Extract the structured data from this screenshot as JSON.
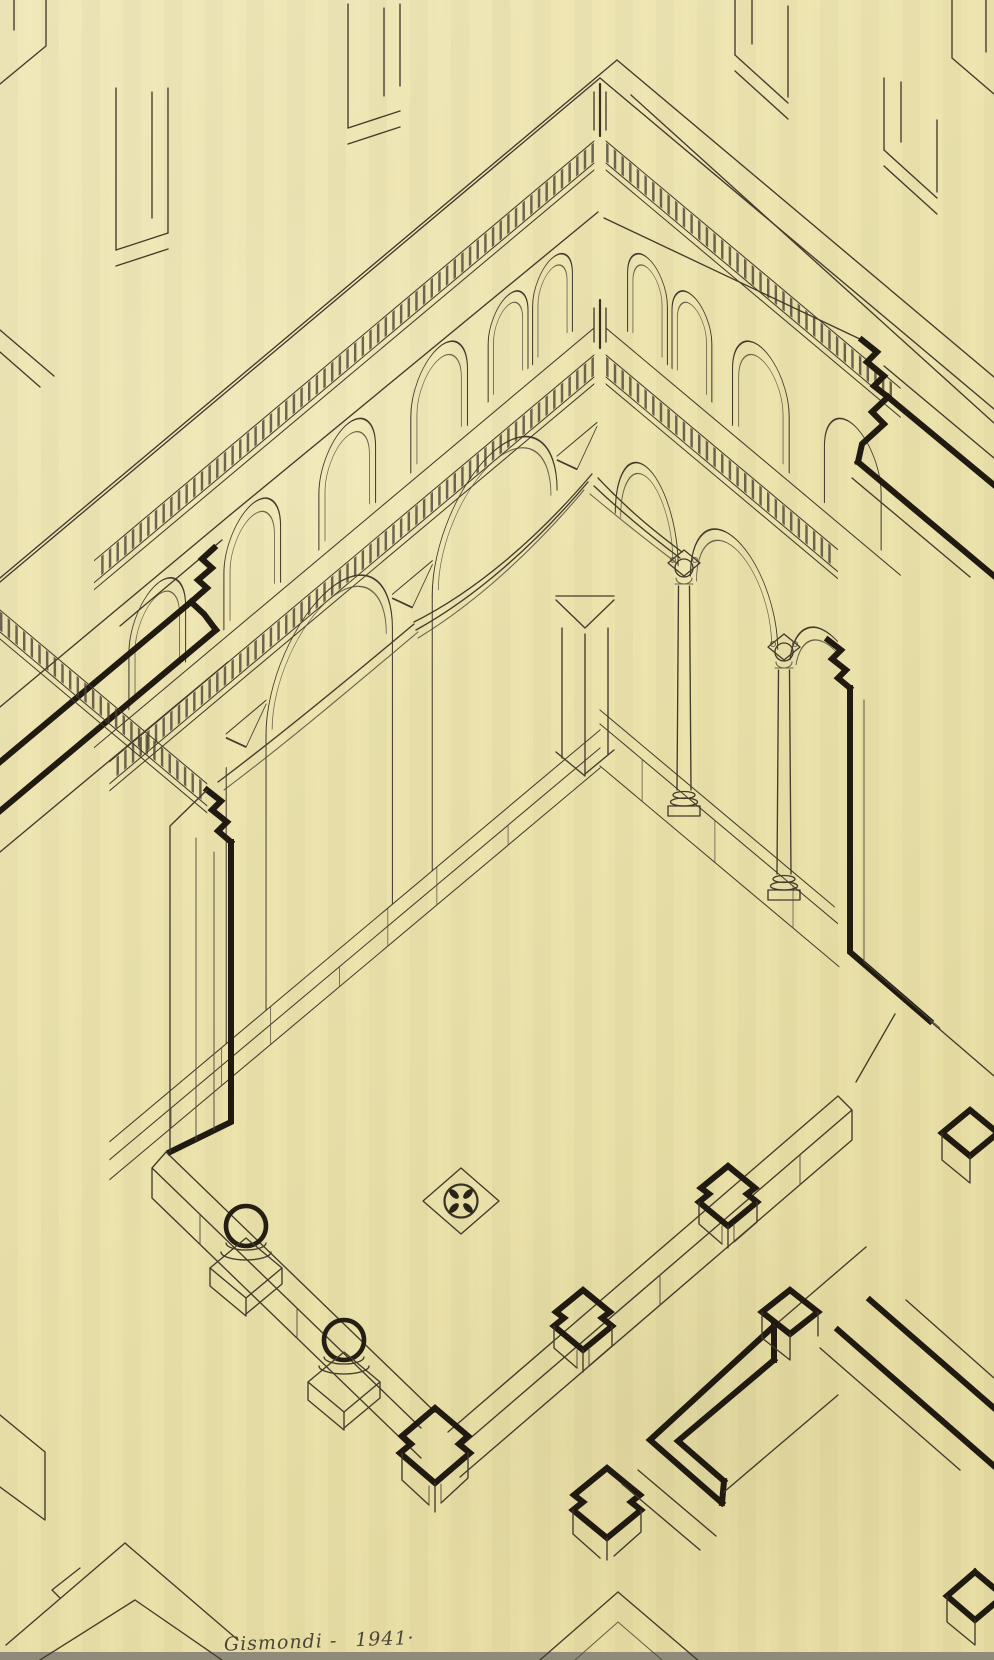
{
  "document": {
    "type": "axonometric cutaway ink drawing of a two-storey arcaded corner (cloister / basilica atrium), sectioned walls shown with heavy outline, on aged yellow paper",
    "signature": "Gismondi -",
    "date": "1941·",
    "palette": {
      "paper": "#ece3ae",
      "paper_light": "#f2eac0",
      "paper_dark": "#e5dba0",
      "ink_thin": "#433b2c",
      "ink_heavy": "#201a10",
      "scan_edge": "#8f8a79"
    },
    "elements": {
      "clerestory": "corner of upper wall with corbel (dentil) tables and round-arched windows on both wings",
      "arcade_level": "lower corbel table, blind wall arches with pilasters on left wing, open column arcade on right wing",
      "columns": "2 free-standing columns with Corinthian capitals and moulded bases",
      "vault": "rib bundles of a cross vault springing from chamfered corbel caps",
      "courtyard": "floor diamond bounded by low stylobate walls with 2 sectioned column stubs and stepped cut piers",
      "floor_ornament": "quatrefoil disc set in a square floor panel",
      "sectioned_walls": "heavy-outlined wall cuts at left, right and lower right with moulded cornice profiles"
    }
  }
}
